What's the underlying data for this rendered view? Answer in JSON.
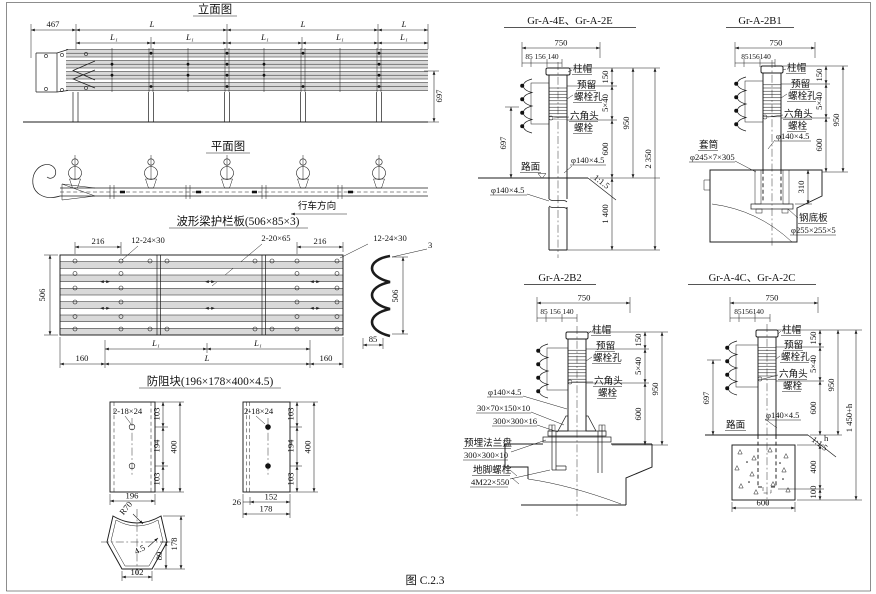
{
  "caption": "图  C.2.3",
  "elevation": {
    "title": "立面图",
    "d467": "467",
    "dL": "L",
    "dL1": "L₁",
    "d697": "697"
  },
  "plan": {
    "title": "平面图",
    "direction": "行车方向"
  },
  "plate": {
    "title": "波形梁护栏板(506×85×3)",
    "d216": "216",
    "holes": "12-24×30",
    "slots": "2-20×65",
    "thick": "3",
    "d506": "506",
    "d85": "85",
    "d160": "160",
    "dL1": "L₁",
    "dL": "L"
  },
  "block": {
    "title": "防阻块(196×178×400×4.5)",
    "holes": "2-18×24",
    "d103": "103",
    "d194": "194",
    "d400": "400",
    "d196": "196",
    "d26": "26",
    "d152": "152",
    "d178": "178",
    "section": {
      "r70": "R70",
      "t": "4.5",
      "d89": "89",
      "d178": "178",
      "d102": "102"
    }
  },
  "labels": {
    "cap": "柱帽",
    "res1": "预留",
    "res2": "螺栓孔",
    "hex1": "六角头",
    "hex2": "螺栓",
    "road": "路面",
    "slope": "1:1.5",
    "pipe": "φ140×4.5"
  },
  "detailA": {
    "title": "Gr-A-4E、Gr-A-2E",
    "d750": "750",
    "dsub": "85 156 140",
    "d150": "150",
    "d5x40": "5×40",
    "d600": "600",
    "d950": "950",
    "d2350": "2 350",
    "d1400": "1 400",
    "d697": "697"
  },
  "detailB": {
    "title": "Gr-A-2B1",
    "d750": "750",
    "dsub": "85156140",
    "d150": "150",
    "d5x40": "5×40",
    "d600": "600",
    "d950": "950",
    "d310": "310",
    "sleeve1": "套筒",
    "sleeve2": "φ245×7×305",
    "base1": "钢底板",
    "base2": "φ255×255×5"
  },
  "detailC": {
    "title": "Gr-A-2B2",
    "d750": "750",
    "dsub": "85 156 140",
    "d150": "150",
    "d5x40": "5×40",
    "d600": "600",
    "d950": "950",
    "gusset": "30×70×150×10",
    "plate16": "300×300×16",
    "flange1": "预埋法兰盘",
    "flange2": "300×300×10",
    "anchor1": "地脚螺栓",
    "anchor2": "4M22×550"
  },
  "detailD": {
    "title": "Gr-A-4C、Gr-A-2C",
    "d750": "750",
    "dsub": "85156140",
    "d150": "150",
    "d5x40": "5×40",
    "d600": "600",
    "d950": "950",
    "d1450": "1 450+h",
    "d400": "400",
    "d100": "100",
    "d600b": "600",
    "d697": "697",
    "h": "h"
  }
}
